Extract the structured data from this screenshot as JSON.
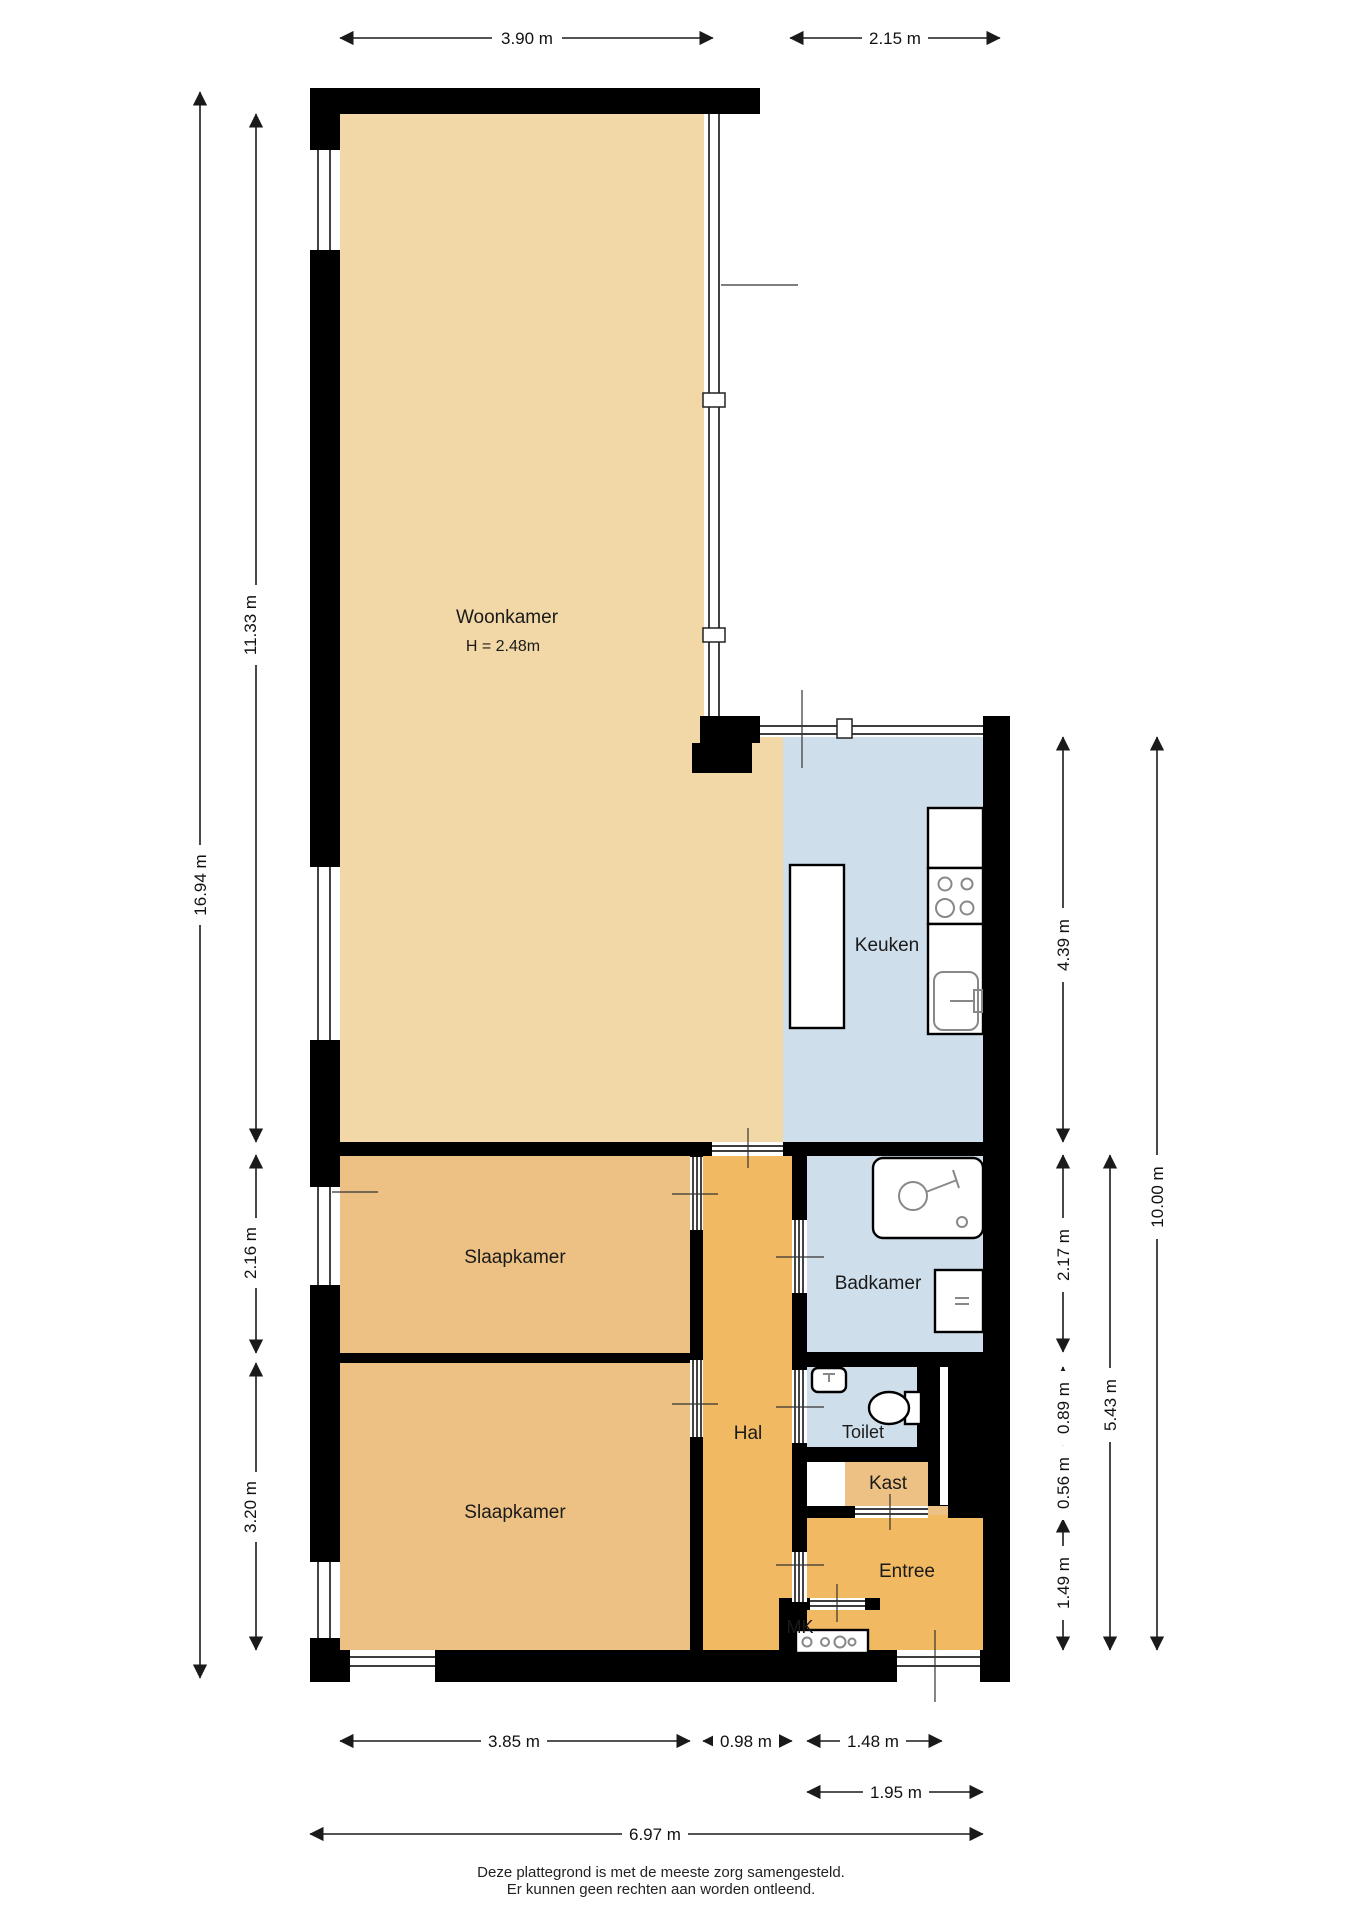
{
  "document": {
    "type": "floor-plan",
    "language": "nl",
    "background": "#ffffff"
  },
  "plan": {
    "rooms": [
      {
        "name": "woonkamer",
        "label": "Woonkamer",
        "note": "H = 2.48m",
        "fill": "#f2d8a6"
      },
      {
        "name": "keuken",
        "label": "Keuken",
        "fill": "#cfdeeb"
      },
      {
        "name": "slaapkamer-1",
        "label": "Slaapkamer",
        "fill": "#ecc183"
      },
      {
        "name": "slaapkamer-2",
        "label": "Slaapkamer",
        "fill": "#ecc183"
      },
      {
        "name": "hal",
        "label": "Hal",
        "fill": "#f1ba62"
      },
      {
        "name": "badkamer",
        "label": "Badkamer",
        "fill": "#cfdeeb"
      },
      {
        "name": "toilet",
        "label": "Toilet",
        "fill": "#cfdeeb"
      },
      {
        "name": "kast",
        "label": "Kast",
        "fill": "#ecc183"
      },
      {
        "name": "entree",
        "label": "Entree",
        "fill": "#f1ba62"
      },
      {
        "name": "mk",
        "label": "MK",
        "fill": "#f1ba62"
      }
    ],
    "wall_color": "#000000",
    "fixtures": [
      "shower",
      "washing-machine",
      "toilet-bowl",
      "hand-basin",
      "kitchen-island",
      "stove",
      "kitchen-sink",
      "kitchen-counter",
      "meter-box"
    ]
  },
  "dimensions": {
    "top": [
      "3.90 m",
      "2.15 m"
    ],
    "left": [
      "11.33 m",
      "16.94 m",
      "2.16 m",
      "3.20 m"
    ],
    "right": [
      "4.39 m",
      "2.17 m",
      "0.89 m",
      "0.56 m",
      "1.49 m",
      "5.43 m",
      "10.00 m"
    ],
    "bottom": [
      "3.85 m",
      "0.98 m",
      "1.48 m",
      "1.95 m",
      "6.97 m"
    ]
  },
  "footer": {
    "line1": "Deze plattegrond is met de meeste zorg samengesteld.",
    "line2": "Er kunnen geen rechten aan worden ontleend."
  }
}
